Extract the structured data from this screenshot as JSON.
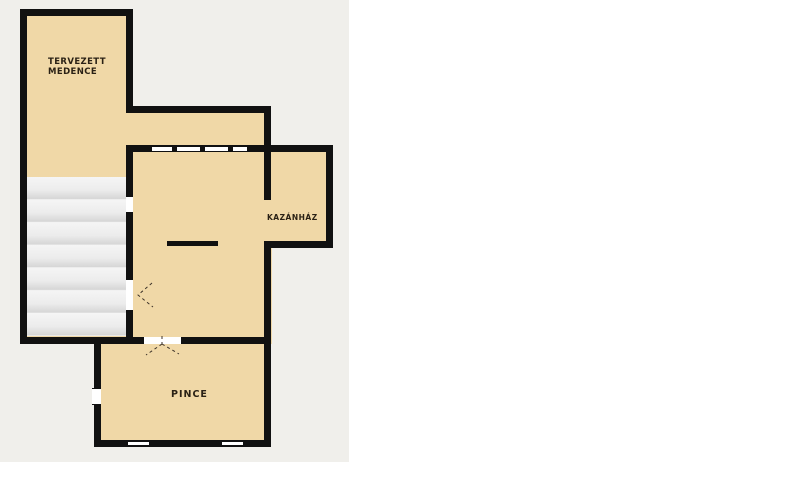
{
  "colors": {
    "canvas_bg": "#ffffff",
    "plan_bg": "#f0efeb",
    "room_fill": "#f0d8a7",
    "wall": "#111111",
    "opening": "#ffffff",
    "stair_light": "#f5f5f5",
    "stair_dark": "#d6d6d6",
    "label_text": "#2a2115",
    "door_swing": "#3c3228"
  },
  "rooms": {
    "pool": {
      "label": "TERVEZETT MEDENCE"
    },
    "boiler": {
      "label": "KAZÁNHÁZ"
    },
    "cellar": {
      "label": "PINCE"
    }
  }
}
